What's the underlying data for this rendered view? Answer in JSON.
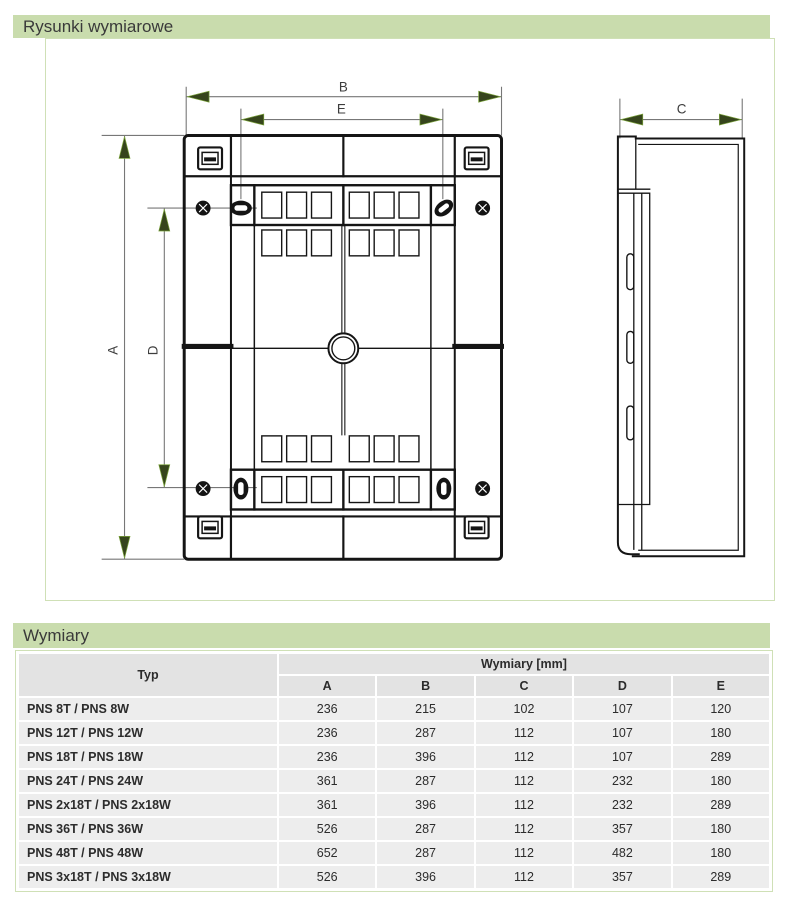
{
  "colors": {
    "section_header_bg": "#c9dcad",
    "section_header_text": "#3a3a3a",
    "panel_border": "#cfe0b6",
    "table_header_bg": "#e3e3e3",
    "table_cell_bg": "#ededed",
    "table_text": "#2c2c2c",
    "dim_line": "#777777",
    "arrow_fill": "#36451c",
    "arrow_edge": "#7aa23a",
    "drawing_stroke": "#151515"
  },
  "sections": {
    "drawings_title": "Rysunki wymiarowe",
    "dimensions_title": "Wymiary"
  },
  "drawing": {
    "dim_labels": {
      "a": "A",
      "b": "B",
      "c": "C",
      "d": "D",
      "e": "E"
    }
  },
  "table": {
    "type_header": "Typ",
    "group_header": "Wymiary [mm]",
    "columns": [
      "A",
      "B",
      "C",
      "D",
      "E"
    ],
    "rows": [
      {
        "typ": "PNS 8T / PNS 8W",
        "values": [
          236,
          215,
          102,
          107,
          120
        ]
      },
      {
        "typ": "PNS 12T / PNS 12W",
        "values": [
          236,
          287,
          112,
          107,
          180
        ]
      },
      {
        "typ": "PNS 18T / PNS 18W",
        "values": [
          236,
          396,
          112,
          107,
          289
        ]
      },
      {
        "typ": "PNS 24T / PNS 24W",
        "values": [
          361,
          287,
          112,
          232,
          180
        ]
      },
      {
        "typ": "PNS 2x18T / PNS 2x18W",
        "values": [
          361,
          396,
          112,
          232,
          289
        ]
      },
      {
        "typ": "PNS 36T / PNS 36W",
        "values": [
          526,
          287,
          112,
          357,
          180
        ]
      },
      {
        "typ": "PNS 48T / PNS 48W",
        "values": [
          652,
          287,
          112,
          482,
          180
        ]
      },
      {
        "typ": "PNS 3x18T / PNS 3x18W",
        "values": [
          526,
          396,
          112,
          357,
          289
        ]
      }
    ]
  }
}
